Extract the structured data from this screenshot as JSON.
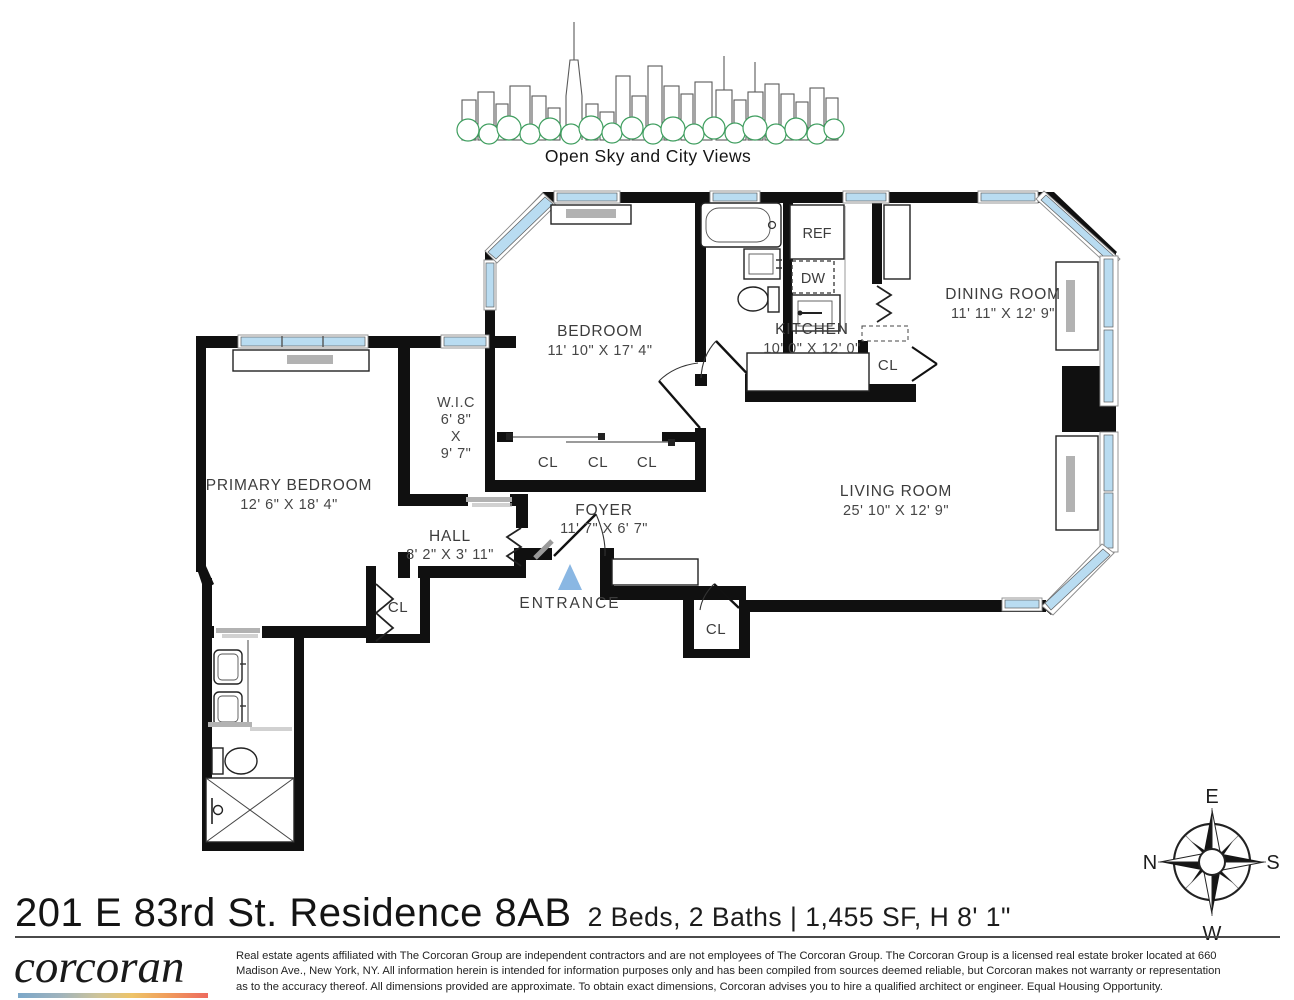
{
  "header": {
    "caption": "Open Sky and City Views"
  },
  "plan": {
    "bedroom_label": "BEDROOM",
    "bedroom_dims": "11' 10\" X 17' 4\"",
    "kitchen_label": "KITCHEN",
    "kitchen_dims": "10' 0\" X 12' 0\"",
    "dining_label": "DINING ROOM",
    "dining_dims": "11' 11\" X 12' 9\"",
    "living_label": "LIVING ROOM",
    "living_dims": "25' 10\" X 12' 9\"",
    "primary_label": "PRIMARY BEDROOM",
    "primary_dims": "12' 6\" X 18' 4\"",
    "wic_label": "W.I.C",
    "wic_d1": "6' 8\"",
    "wic_x": "X",
    "wic_d2": "9' 7\"",
    "hall_label": "HALL",
    "hall_dims": "8' 2\" X 3' 11\"",
    "foyer_label": "FOYER",
    "foyer_dims": "11' 7\" X 6' 7\"",
    "entrance_label": "ENTRANCE",
    "closet": "CL",
    "fridge": "REF",
    "dishwasher": "DW"
  },
  "colors": {
    "window_blue": "#b9dcf1",
    "entrance_blue": "#8ab7e3",
    "tree_green": "#3f9e5f",
    "wall_black": "#101010"
  },
  "compass": {
    "e": "E",
    "s": "S",
    "w": "W",
    "n": "N"
  },
  "footer": {
    "title": "201 E 83rd St. Residence 8AB",
    "specs": "2 Beds, 2 Baths | 1,455 SF, H 8' 1\"",
    "brand": "corcoran",
    "disclaimer_line1": "Real estate agents affiliated with The Corcoran Group are independent contractors and are not employees of The Corcoran Group. The Corcoran Group is a licensed real estate broker located at 660",
    "disclaimer_line2": "Madison Ave., New York, NY. All information herein is intended for information purposes only and has been compiled from sources deemed reliable, but Corcoran makes not warranty or representation",
    "disclaimer_line3": "as to the accuracy thereof. All dimensions provided are approximate. To obtain exact dimensions, Corcoran advises you to hire a qualified architect or engineer. Equal Housing Opportunity."
  }
}
